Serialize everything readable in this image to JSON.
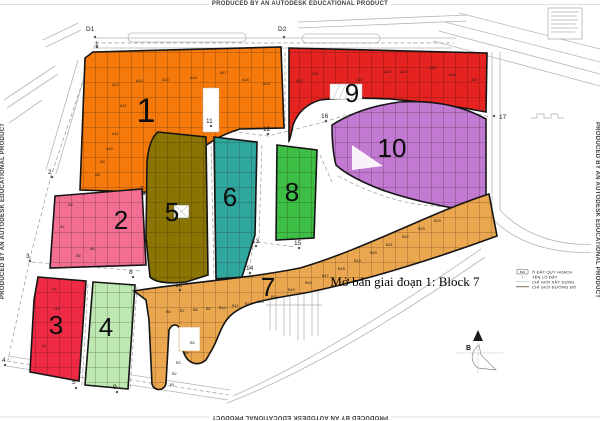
{
  "watermark": "PRODUCED BY AN AUTODESK EDUCATIONAL PRODUCT",
  "title": "Mở bán giai đoạn 1: Block 7",
  "compass": {
    "north_label": "B"
  },
  "legend": {
    "items": [
      {
        "symbol": "B24",
        "label": "Ô ĐẤT QUY HOẠCH"
      },
      {
        "symbol": "7",
        "label": "TÊN LÔ ĐẤT"
      },
      {
        "symbol": "",
        "label": "CHỈ GIỚI XÂY DỰNG"
      },
      {
        "symbol": "",
        "label": "CHỈ GIỚI ĐƯỜNG ĐỎ"
      }
    ]
  },
  "nodes": {
    "d1": "D1",
    "d2": "D2",
    "n1": "1",
    "n2": "2",
    "n3": "3",
    "n4": "4",
    "n5": "5",
    "n7": "7",
    "n8": "8",
    "n9": "9",
    "n10": "10",
    "n11": "11",
    "n12": "12",
    "n13": "13",
    "n14": "14",
    "n15": "15",
    "n16": "16",
    "n17": "17"
  },
  "blocks": [
    {
      "number": "1",
      "color": "#F5790B",
      "lots": [
        "A8",
        "A9",
        "A10",
        "A11",
        "A12",
        "A13",
        "A14",
        "A15",
        "A16",
        "A17",
        "A18",
        "A19"
      ]
    },
    {
      "number": "2",
      "color": "#F26E93",
      "lots": [
        "A5",
        "A6",
        "A7",
        "A8"
      ]
    },
    {
      "number": "3",
      "color": "#EF2A44",
      "lots": [
        "A1",
        "A2",
        "A3",
        "A4"
      ]
    },
    {
      "number": "4",
      "color": "#BDE8B2",
      "lots": []
    },
    {
      "number": "5",
      "color": "#8A7403",
      "lots": []
    },
    {
      "number": "6",
      "color": "#30A79E",
      "lots": []
    },
    {
      "number": "7",
      "color": "#EAA74F",
      "lots": [
        "B1",
        "B2",
        "B3",
        "B4",
        "B5",
        "B6",
        "B7",
        "B8",
        "B9",
        "B10",
        "B11",
        "B12",
        "B13",
        "B14",
        "B15",
        "B16",
        "B17",
        "B18",
        "B19",
        "B20",
        "B21",
        "B22",
        "B23",
        "B24"
      ]
    },
    {
      "number": "8",
      "color": "#3DBE44",
      "lots": []
    },
    {
      "number": "9",
      "color": "#E52320",
      "lots": [
        "A20",
        "A21",
        "A22",
        "A23",
        "A24",
        "A25",
        "A26",
        "A27"
      ]
    },
    {
      "number": "10",
      "color": "#C179D2",
      "lots": []
    }
  ]
}
